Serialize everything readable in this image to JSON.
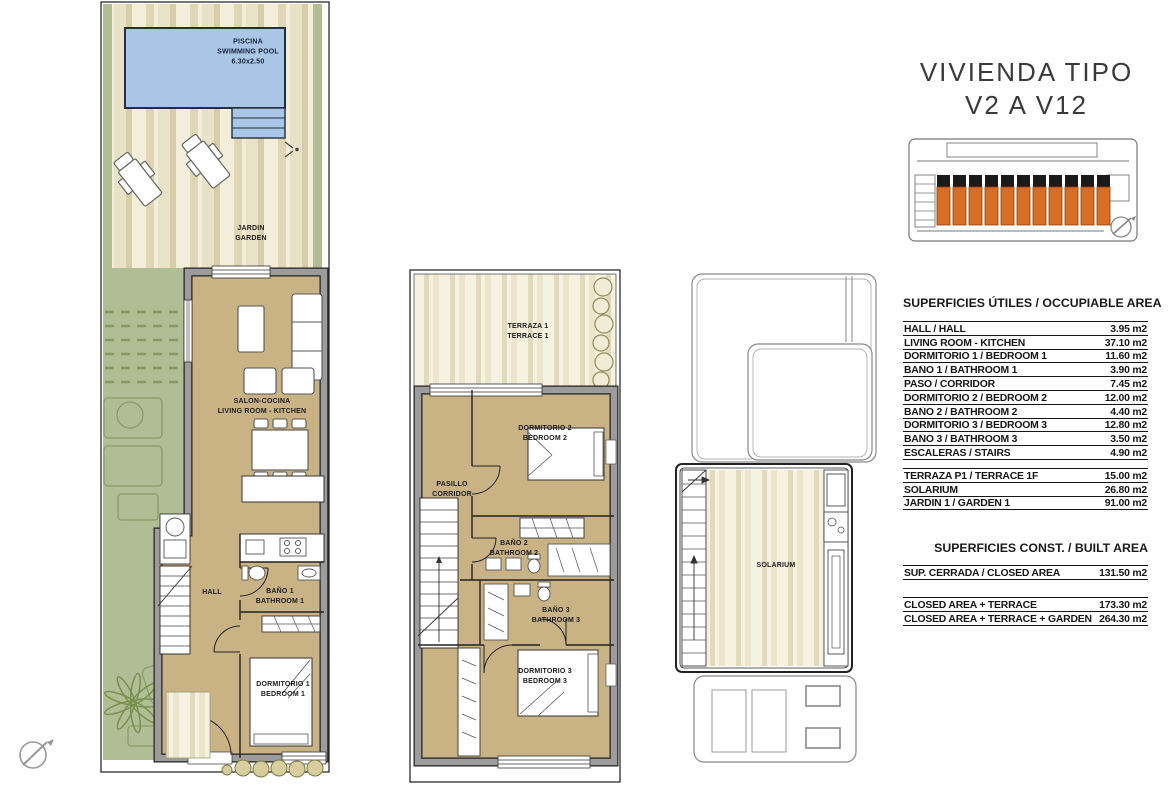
{
  "title": {
    "line1": "VIVIENDA TIPO",
    "line2": "V2 A V12"
  },
  "plans": {
    "ground": {
      "pool": {
        "line1": "PISCINA",
        "line2": "SWIMMING POOL",
        "line3": "6.30x2.50"
      },
      "garden": {
        "line1": "JARDIN",
        "line2": "GARDEN"
      },
      "living": {
        "line1": "SALON-COCINA",
        "line2": "LIVING ROOM - KITCHEN"
      },
      "hall": {
        "line1": "HALL"
      },
      "bath1": {
        "line1": "BAÑO 1",
        "line2": "BATHROOM 1"
      },
      "bed1": {
        "line1": "DORMITORIO 1",
        "line2": "BEDROOM 1"
      }
    },
    "first": {
      "terrace": {
        "line1": "TERRAZA 1",
        "line2": "TERRACE 1"
      },
      "bed2": {
        "line1": "DORMITORIO 2",
        "line2": "BEDROOM 2"
      },
      "corridor": {
        "line1": "PASILLO",
        "line2": "CORRIDOR"
      },
      "bath2": {
        "line1": "BAÑO 2",
        "line2": "BATHROOM 2"
      },
      "bath3": {
        "line1": "BAÑO 3",
        "line2": "BATHROOM 3"
      },
      "bed3": {
        "line1": "DORMITORIO 3",
        "line2": "BEDROOM 3"
      }
    },
    "solarium": {
      "label": "SOLARIUM"
    }
  },
  "tables": {
    "occupiable": {
      "header": "SUPERFICIES ÚTILES / OCCUPIABLE AREA",
      "rows": [
        {
          "label": "HALL / HALL",
          "value": "3.95 m2"
        },
        {
          "label": "LIVING ROOM - KITCHEN",
          "value": "37.10 m2"
        },
        {
          "label": "DORMITORIO 1 /  BEDROOM 1",
          "value": "11.60 m2"
        },
        {
          "label": "BAÑO 1 / BATHROOM 1",
          "value": "3.90 m2"
        },
        {
          "label": "PASO / CORRIDOR",
          "value": "7.45 m2"
        },
        {
          "label": "DORMITORIO 2 / BEDROOM 2",
          "value": "12.00 m2"
        },
        {
          "label": "BAÑO 2 / BATHROOM 2",
          "value": "4.40 m2"
        },
        {
          "label": "DORMITORIO 3 / BEDROOM 3",
          "value": "12.80 m2"
        },
        {
          "label": "BAÑO 3 / BATHROOM 3",
          "value": "3.50 m2"
        },
        {
          "label": "ESCALERAS / STAIRS",
          "value": "4.90 m2"
        }
      ]
    },
    "exterior": {
      "rows": [
        {
          "label": "TERRAZA P1 / TERRACE 1F",
          "value": "15.00 m2"
        },
        {
          "label": "SOLARIUM",
          "value": "26.80 m2"
        },
        {
          "label": "JARDIN 1 / GARDEN 1",
          "value": "91.00 m2"
        }
      ]
    },
    "built": {
      "header": "SUPERFICIES  CONST. / BUILT AREA",
      "closed_row": {
        "label": "SUP. CERRADA / CLOSED AREA",
        "value": "131.50 m2"
      },
      "totals": [
        {
          "label": "CLOSED AREA + TERRACE",
          "value": "173.30 m2"
        },
        {
          "label": "CLOSED AREA + TERRACE + GARDEN",
          "value": "264.30 m2"
        }
      ]
    }
  },
  "key_plan": {
    "highlighted_units": 11
  },
  "icons": [
    "north-compass-icon",
    "keyplan-compass-icon"
  ],
  "colors": {
    "pool_blue": "#a9c6e6",
    "floor_tan": "#c9b384",
    "lawn_green": "#b1bd94",
    "wall_gray": "#9c9c9c",
    "unit_orange": "#d96f26"
  }
}
